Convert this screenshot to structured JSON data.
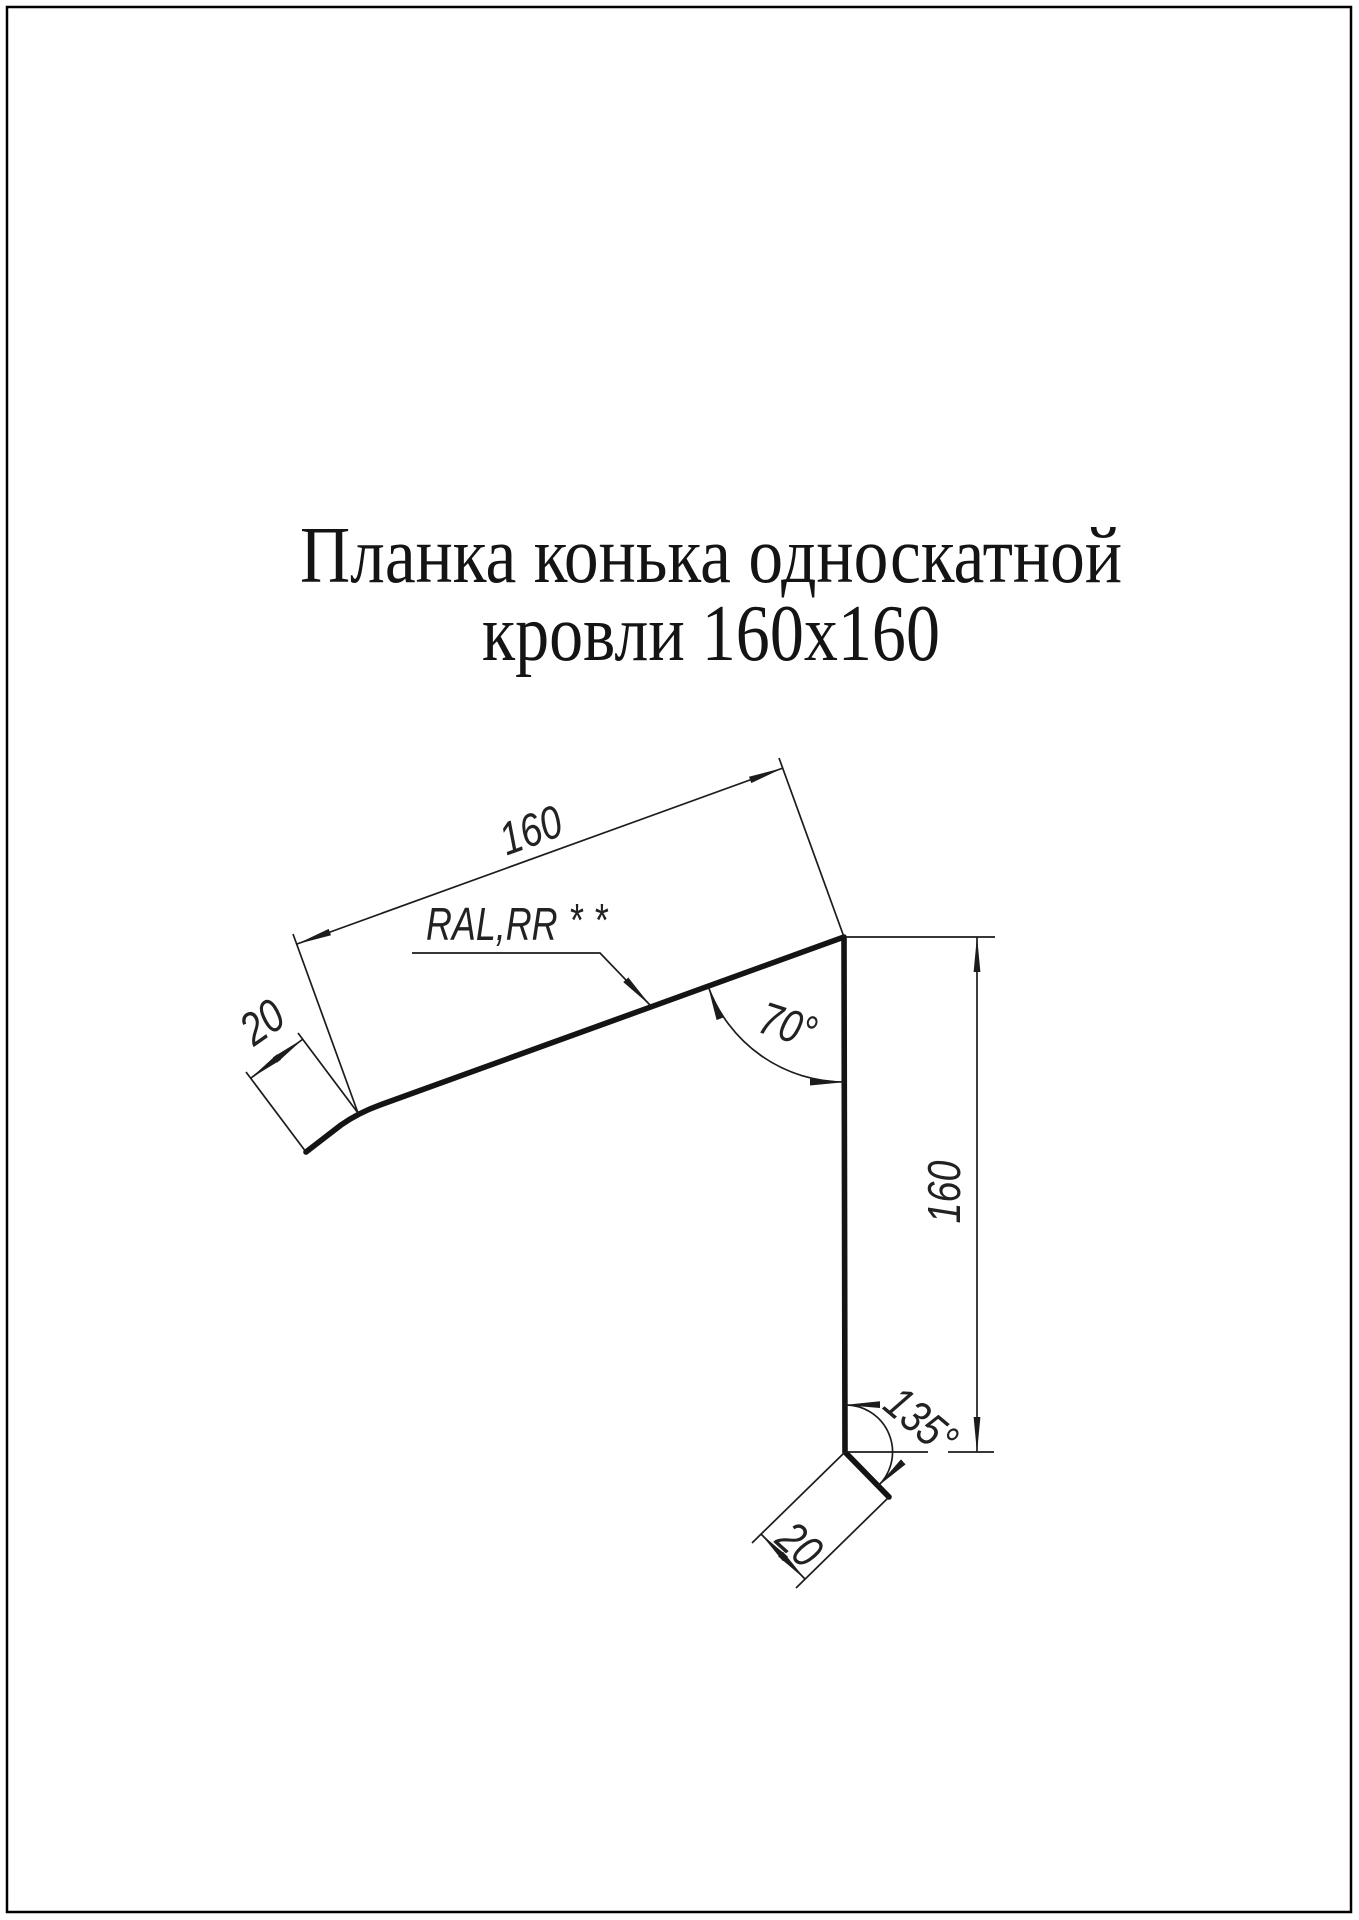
{
  "title": {
    "line1": "Планка конька односкатной",
    "line2": "кровли 160х160"
  },
  "dimensions": {
    "slope_length": "160",
    "vertical_length": "160",
    "top_flange_length": "20",
    "bottom_flange_length": "20",
    "top_angle": "70°",
    "bottom_angle": "135°"
  },
  "annotations": {
    "coating_label": "RAL,RR",
    "coating_stars": "**"
  },
  "colors": {
    "line": "#1c1c1c",
    "background": "#ffffff",
    "border": "#000000"
  }
}
